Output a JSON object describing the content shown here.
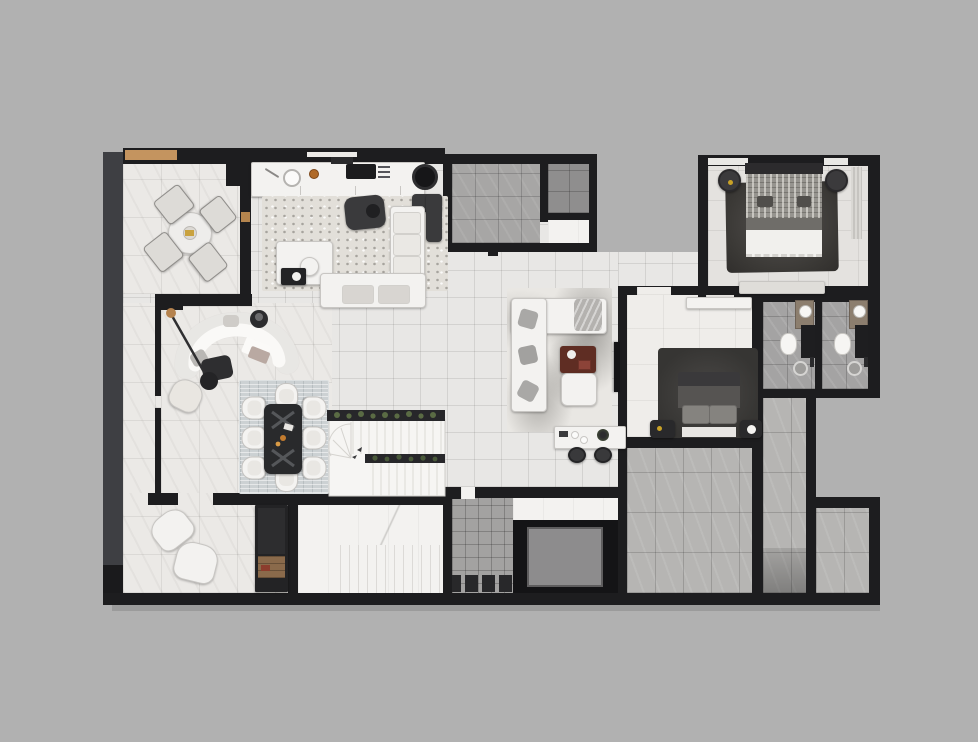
{
  "meta": {
    "title": "Apartment floor plan — top-down 3D architectural render",
    "type": "floor-plan-render",
    "view": "top-down",
    "notes": "Monochrome render of a furnished apartment level; no text labels visible in image"
  },
  "palette": {
    "background": "#b1b1b1",
    "walls": "#1d1d1f",
    "outer_band": "#3e3f43",
    "floor_light_grid": "#e8e7e5",
    "floor_marble": "#ebe9e6",
    "floor_white": "#f3f2f0",
    "floor_gray": "#a7a6a5",
    "floor_gray_dark": "#8f8e8e",
    "floor_gray_big": "#b6b5b3",
    "accent_wood": "#c4945f",
    "accent_maroon": "#5f2d23",
    "accent_green": "#5a6b44",
    "accent_gold": "#c9a227"
  },
  "rooms": {
    "balcony": {
      "label": "Balcony terrace",
      "furniture": "round table, 4 terrace chairs"
    },
    "kitchen": {
      "label": "Open kitchen and living",
      "furniture": "counter with sink and cooktop, island, speckled rug, dark lounge chair, L-shaped sofa"
    },
    "lounge": {
      "label": "Curved-sofa lounge",
      "furniture": "crescent sofa, arc floor lamp, dark coffee table, side table, armchair"
    },
    "dining": {
      "label": "Dining area",
      "furniture": "dark dining table, 8 chairs, woven rug"
    },
    "family": {
      "label": "Family TV room",
      "furniture": "sectional sofa, maroon coffee table, ottoman, wall TV, console desk, 2 stools, marble rug"
    },
    "stairs_upper": {
      "label": "Main staircase with planters"
    },
    "stairs_lower": {
      "label": "Lower staircase"
    },
    "utility_large": {
      "label": "Utility room"
    },
    "utility_small": {
      "label": "Storage room"
    },
    "utility_white": {
      "label": "Pantry"
    },
    "corridor": {
      "label": "Corridor"
    },
    "hall_upper": {
      "label": "Bedroom hallway"
    },
    "bedroom1": {
      "label": "Bedroom 1",
      "furniture": "double bed, 2 round poufs, dark rug, bench, curtain"
    },
    "bedroom2": {
      "label": "Bedroom 2",
      "furniture": "double bed, 2 nightstands, dark rug, dresser, wall TV"
    },
    "bathroom1": {
      "label": "Bathroom 1",
      "furniture": "washbasin, toilet, shower"
    },
    "bathroom2": {
      "label": "Bathroom 2",
      "furniture": "washbasin, toilet, shower"
    },
    "hall_lower": {
      "label": "Lower hall",
      "furniture": "2 armchairs, tall dark cabinet with wood shelf"
    },
    "elevator": {
      "label": "Elevator shaft"
    },
    "mosaic_room": {
      "label": "Small tiled room"
    },
    "room_b1": {
      "label": "Unfurnished room"
    },
    "room_b2": {
      "label": "Unfurnished room"
    },
    "room_b3": {
      "label": "Unfurnished room"
    }
  }
}
